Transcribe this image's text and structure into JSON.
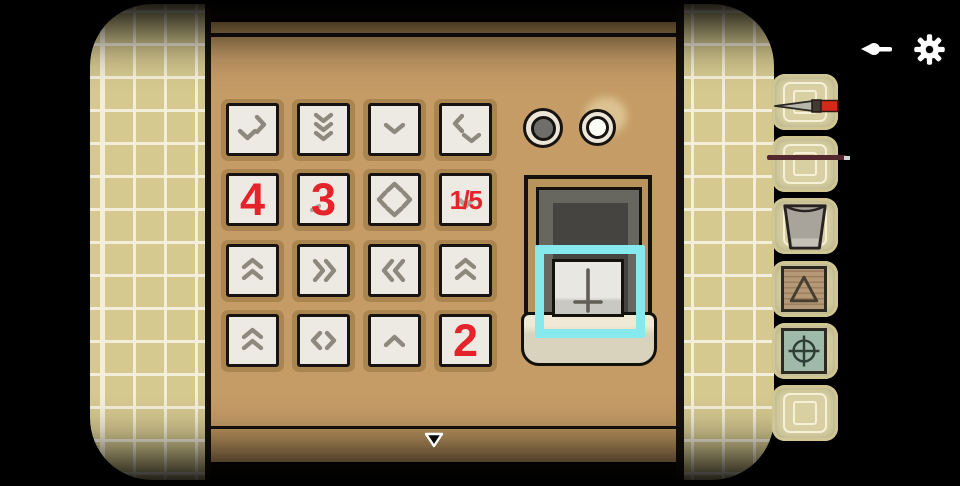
{
  "topbar": {
    "icons": [
      {
        "name": "exit-arrow-icon"
      },
      {
        "name": "settings-gear-icon"
      }
    ]
  },
  "keypad": {
    "number_color": "#e4232a",
    "chevron_color": "#8d897e",
    "cells": [
      {
        "symbol": "chevron-down-right",
        "label": ""
      },
      {
        "symbol": "triple-chevron-down",
        "label": ""
      },
      {
        "symbol": "chevron-down",
        "label": ""
      },
      {
        "symbol": "chevron-left-down",
        "label": ""
      },
      {
        "symbol": "none",
        "label": "4"
      },
      {
        "symbol": "fragment-bottom-left",
        "label": "3"
      },
      {
        "symbol": "diamond-chevrons",
        "label": ""
      },
      {
        "symbol": "chevron-down-faint",
        "label": "1/5"
      },
      {
        "symbol": "double-chevron-up",
        "label": ""
      },
      {
        "symbol": "double-chevron-right",
        "label": ""
      },
      {
        "symbol": "double-chevron-left",
        "label": ""
      },
      {
        "symbol": "double-chevron-up",
        "label": ""
      },
      {
        "symbol": "double-chevron-up",
        "label": ""
      },
      {
        "symbol": "chevron-left-right",
        "label": ""
      },
      {
        "symbol": "chevron-up",
        "label": ""
      },
      {
        "symbol": "none",
        "label": "2"
      }
    ]
  },
  "lights": [
    {
      "name": "indicator-light-off",
      "state": "off",
      "core_color": "#6f6e6b"
    },
    {
      "name": "indicator-light-on",
      "state": "on",
      "core_color": "#fdfdf8"
    }
  ],
  "display": {
    "card_symbol": "inverted-cross-icon",
    "highlight_color": "#86e9ee"
  },
  "nav": {
    "down_arrow": "down-triangle-icon"
  },
  "inventory": {
    "slots": [
      {
        "item": "paintbrush-icon"
      },
      {
        "item": "metal-rod-icon"
      },
      {
        "item": "cup-icon"
      },
      {
        "item": "triangle-tile-icon"
      },
      {
        "item": "crosshair-tile-icon"
      },
      {
        "item": "empty"
      }
    ]
  }
}
